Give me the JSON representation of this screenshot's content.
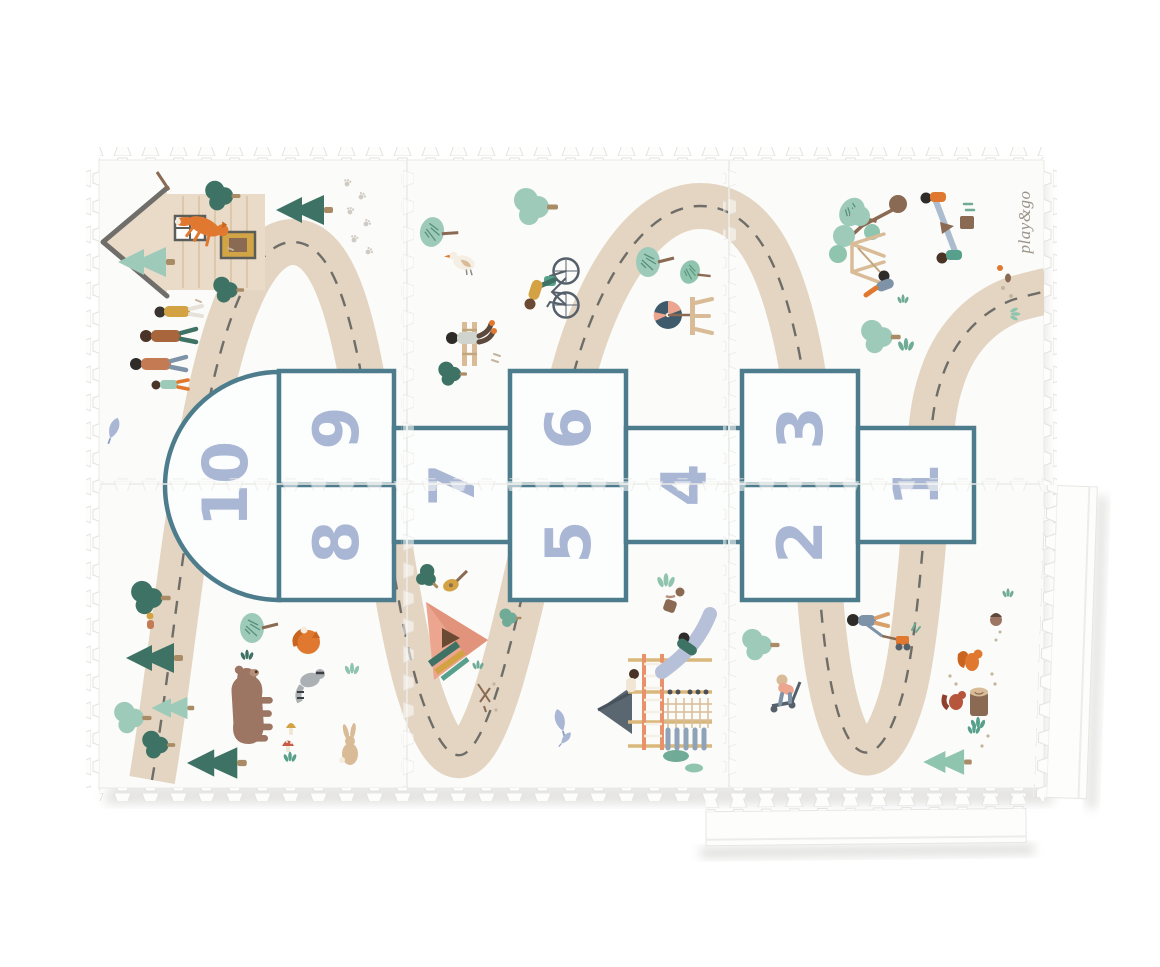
{
  "scene": {
    "background": "#ffffff",
    "brand_label": "play&go"
  },
  "mat": {
    "grid": {
      "columns": 3,
      "rows": 2,
      "loose_edge_strips": 2
    },
    "colors": {
      "mat_base": "#fbfbf9",
      "edge_outline": "#e2e2df",
      "road": "#e4d5c2",
      "road_dashes": "#6e6d68",
      "hopscotch_border": "#4d7d8d",
      "hopscotch_fill": "#fcfdfd",
      "number_blue": "#a9b7d5",
      "pine_dark": "#3e7264",
      "leaf_mint": "#9ecbb9",
      "leaf_teal": "#6fab97",
      "wood_tan": "#d9bc97",
      "accent_orange": "#e0792f",
      "accent_mustard": "#d3a243",
      "accent_coral": "#eca58f",
      "bear_brown": "#9d7663",
      "slate": "#55606b",
      "slide_periwinkle": "#b6c0d8"
    }
  },
  "hopscotch": {
    "numbers": [
      "10",
      "9",
      "8",
      "7",
      "6",
      "5",
      "4",
      "3",
      "2",
      "1"
    ]
  }
}
